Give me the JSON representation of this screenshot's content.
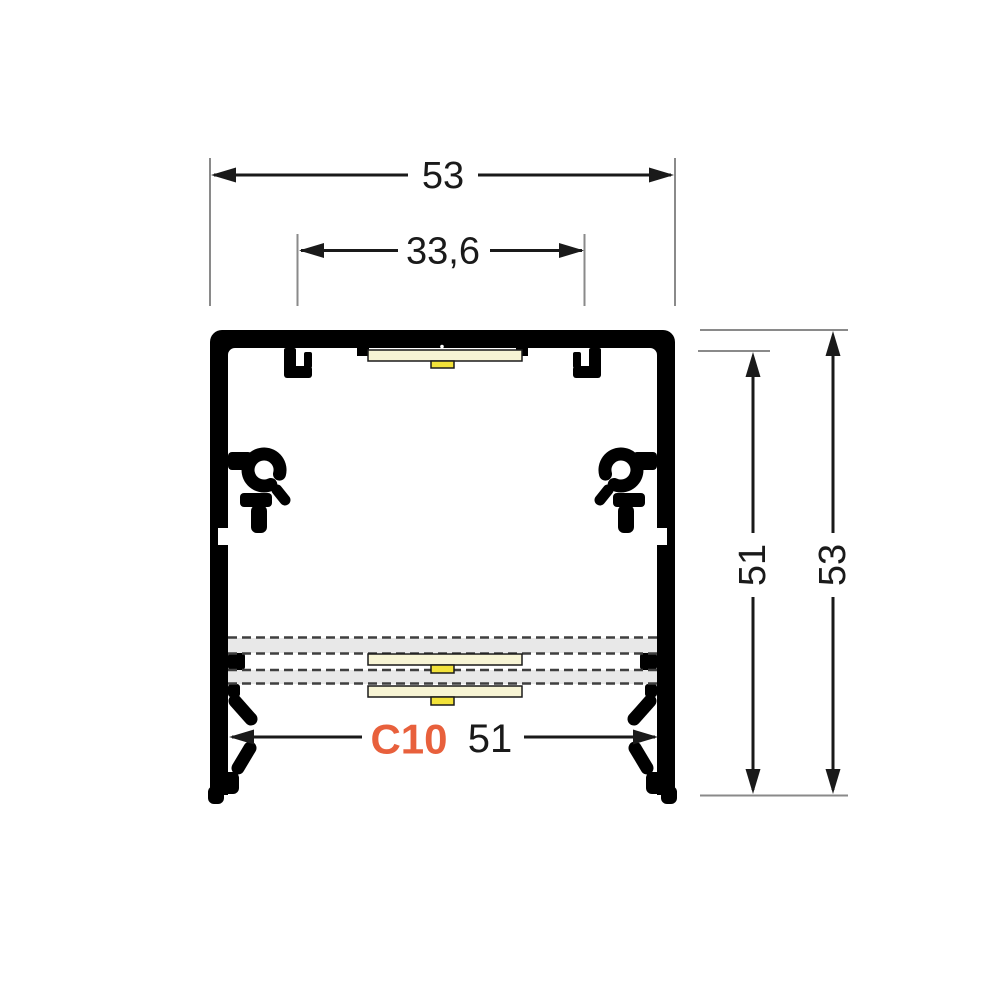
{
  "diagram": {
    "title": "LED profile cross-section drawing",
    "label": {
      "text": "C10",
      "color": "#e8603c"
    },
    "dimensions": {
      "outer_width": "53",
      "opening_width": "33,6",
      "inner_height": "51",
      "outer_height": "53",
      "bottom_width": "51"
    },
    "colors": {
      "profile": "#000000",
      "diffuser_band": "#e8e8e8",
      "dashed_line": "#3f3f3f",
      "led_strip": "#f7f4d4",
      "led_chip": "#f2e23a",
      "dimension_line": "#1a1a1a",
      "extension_line": "#8a8a8a",
      "background": "#ffffff"
    }
  }
}
